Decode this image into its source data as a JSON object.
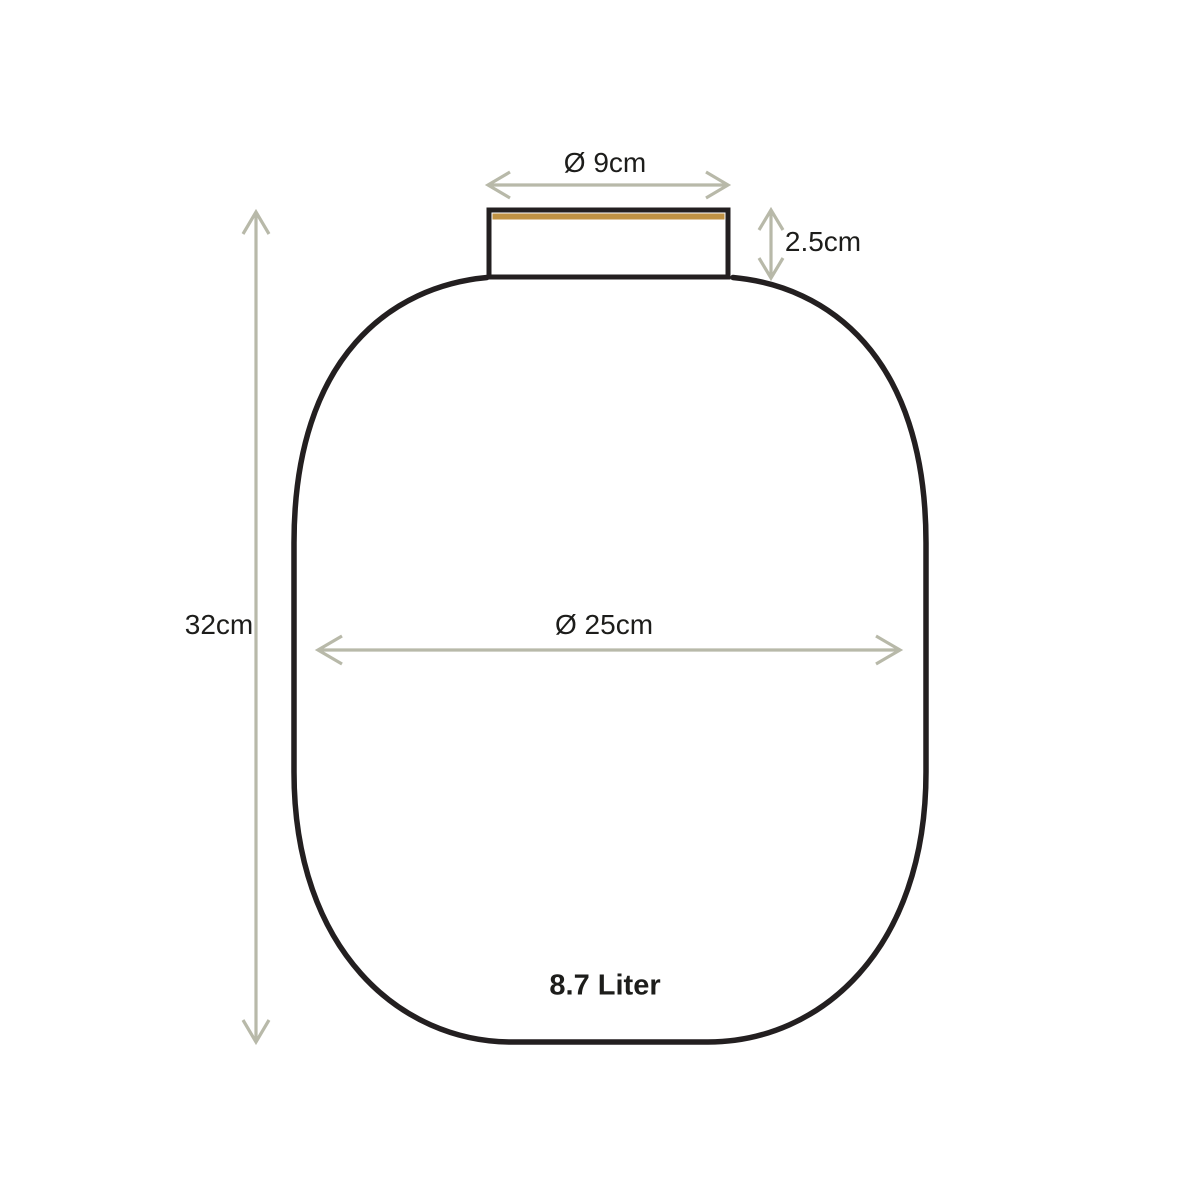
{
  "diagram": {
    "labels": {
      "top_diameter": "Ø 9cm",
      "neck_height": "2.5cm",
      "total_height": "32cm",
      "body_diameter": "Ø 25cm",
      "volume": "8.7 Liter"
    },
    "colors": {
      "outline": "#231f20",
      "gold": "#c09244",
      "dimension": "#b8b9a9",
      "text": "#1d1d1b",
      "background": "#ffffff"
    }
  }
}
